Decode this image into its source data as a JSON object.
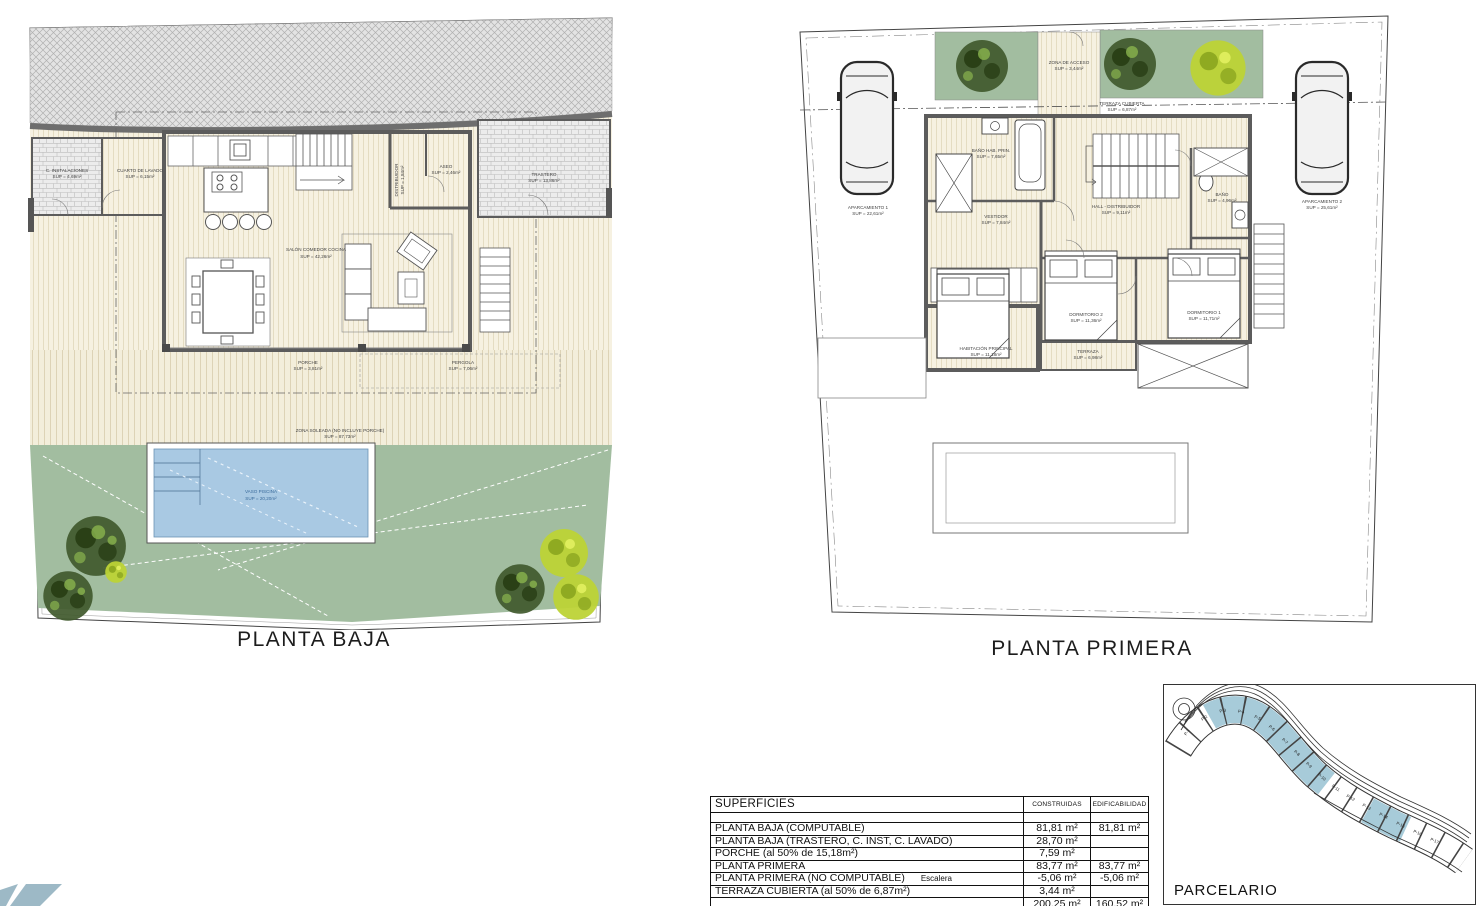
{
  "planta_baja": {
    "title": "PLANTA BAJA",
    "rooms": {
      "c_instalaciones": {
        "name": "C. INSTALACIONES",
        "sup": "SUP = 4,69m²"
      },
      "cuarto_lavado": {
        "name": "CUARTO DE LAVADO",
        "sup": "SUP = 6,15m²"
      },
      "trastero": {
        "name": "TRASTERO",
        "sup": "SUP = 13,86m²"
      },
      "distribuidor": {
        "name": "DISTRIBUIDOR",
        "sup": "SUP = 1,84m²"
      },
      "aseo": {
        "name": "ASEO",
        "sup": "SUP = 2,46m²"
      },
      "salon": {
        "name": "SALÓN COMEDOR COCINA",
        "sup": "SUP = 42,26m²"
      },
      "porche": {
        "name": "PORCHE",
        "sup": "SUP = 3,81m²"
      },
      "pergola": {
        "name": "PERGOLA",
        "sup": "SUP = 7,06m²"
      },
      "zona_soleada": {
        "name": "ZONA SOLEADA (NO INCLUYE PORCHE)",
        "sup": "SUP = 87,73m²"
      },
      "vaso_piscina": {
        "name": "VASO PISCINA",
        "sup": "SUP = 20,20m²"
      }
    }
  },
  "planta_primera": {
    "title": "PLANTA PRIMERA",
    "rooms": {
      "zona_acceso": {
        "name": "ZONA DE ACCESO",
        "sup": "SUP = 3,44m²"
      },
      "terraza_cubierta": {
        "name": "TERRAZA CUBIERTA",
        "sup": "SUP = 6,87m²"
      },
      "aparcamiento_1": {
        "name": "APARCAMIENTO 1",
        "sup": "SUP = 22,61m²"
      },
      "aparcamiento_2": {
        "name": "APARCAMIENTO 2",
        "sup": "SUP = 25,61m²"
      },
      "bano_hab_prin": {
        "name": "BAÑO HAB. PRIN.",
        "sup": "SUP = 7,65m²"
      },
      "vestidor": {
        "name": "VESTIDOR",
        "sup": "SUP = 7,84m²"
      },
      "hall_distribuidor": {
        "name": "HALL - DISTRIBUIDOR",
        "sup": "SUP = 9,11m²"
      },
      "bano": {
        "name": "BAÑO",
        "sup": "SUP = 4,96m²"
      },
      "habitacion_principal": {
        "name": "HABITACIÓN PRINCIPAL",
        "sup": "SUP = 11,18m²"
      },
      "dormitorio_2": {
        "name": "DORMITORIO 2",
        "sup": "SUP = 11,36m²"
      },
      "dormitorio_1": {
        "name": "DORMITORIO 1",
        "sup": "SUP = 11,71m²"
      },
      "terraza": {
        "name": "TERRAZA",
        "sup": "SUP = 6,98m²"
      }
    }
  },
  "superficies_table": {
    "title": "SUPERFICIES",
    "col_construidas": "CONSTRUIDAS",
    "col_edificabilidad": "EDIFICABILIDAD",
    "rows": [
      {
        "label": "PLANTA BAJA (COMPUTABLE)",
        "note": "",
        "construidas": "81,81 m²",
        "edificabilidad": "81,81 m²"
      },
      {
        "label": "PLANTA BAJA (TRASTERO, C. INST, C. LAVADO)",
        "note": "",
        "construidas": "28,70 m²",
        "edificabilidad": ""
      },
      {
        "label": "PORCHE (al 50% de 15,18m²)",
        "note": "",
        "construidas": "7,59 m²",
        "edificabilidad": ""
      },
      {
        "label": "PLANTA PRIMERA",
        "note": "",
        "construidas": "83,77 m²",
        "edificabilidad": "83,77 m²"
      },
      {
        "label": "PLANTA PRIMERA (NO COMPUTABLE)",
        "note": "Escalera",
        "construidas": "-5,06 m²",
        "edificabilidad": "-5,06 m²"
      },
      {
        "label": "TERRAZA CUBIERTA (al 50% de 6,87m²)",
        "note": "",
        "construidas": "3,44 m²",
        "edificabilidad": ""
      }
    ],
    "total": {
      "construidas": "200,25 m²",
      "edificabilidad": "160,52 m²"
    }
  },
  "parcelario": {
    "title": "PARCELARIO",
    "parcels": [
      "P-1",
      "P-2",
      "P-3",
      "P-4",
      "P-5",
      "P-6",
      "P-7",
      "P-8",
      "P-9",
      "P-10",
      "P-11",
      "P-12",
      "P-13",
      "P-14",
      "P-15",
      "P-16",
      "P-17"
    ]
  }
}
